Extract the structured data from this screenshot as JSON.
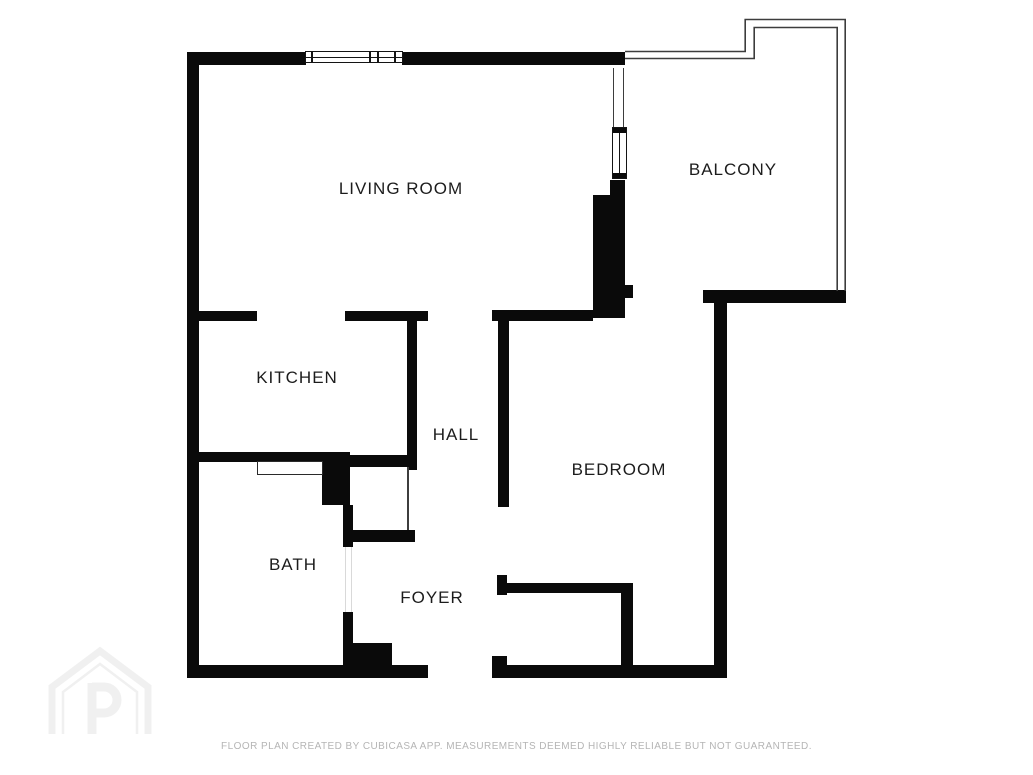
{
  "plan": {
    "title": "Apartment floor plan",
    "rooms": [
      {
        "id": "living-room",
        "label": "LIVING ROOM"
      },
      {
        "id": "balcony",
        "label": "BALCONY"
      },
      {
        "id": "kitchen",
        "label": "KITCHEN"
      },
      {
        "id": "hall",
        "label": "HALL"
      },
      {
        "id": "bedroom",
        "label": "BEDROOM"
      },
      {
        "id": "bath",
        "label": "BATH"
      },
      {
        "id": "foyer",
        "label": "FOYER"
      }
    ]
  },
  "footer": {
    "disclaimer": "FLOOR PLAN CREATED BY CUBICASA APP. MEASUREMENTS DEEMED HIGHLY RELIABLE BUT NOT GUARANTEED."
  },
  "branding": {
    "logo": "cubicasa-house-p-logo"
  },
  "colors": {
    "wall": "#0a0a0a",
    "label": "#1c1c1c",
    "railing": "#3d3d3d",
    "disclaimer": "#b5b5b5",
    "watermark": "#f0f0f0"
  }
}
